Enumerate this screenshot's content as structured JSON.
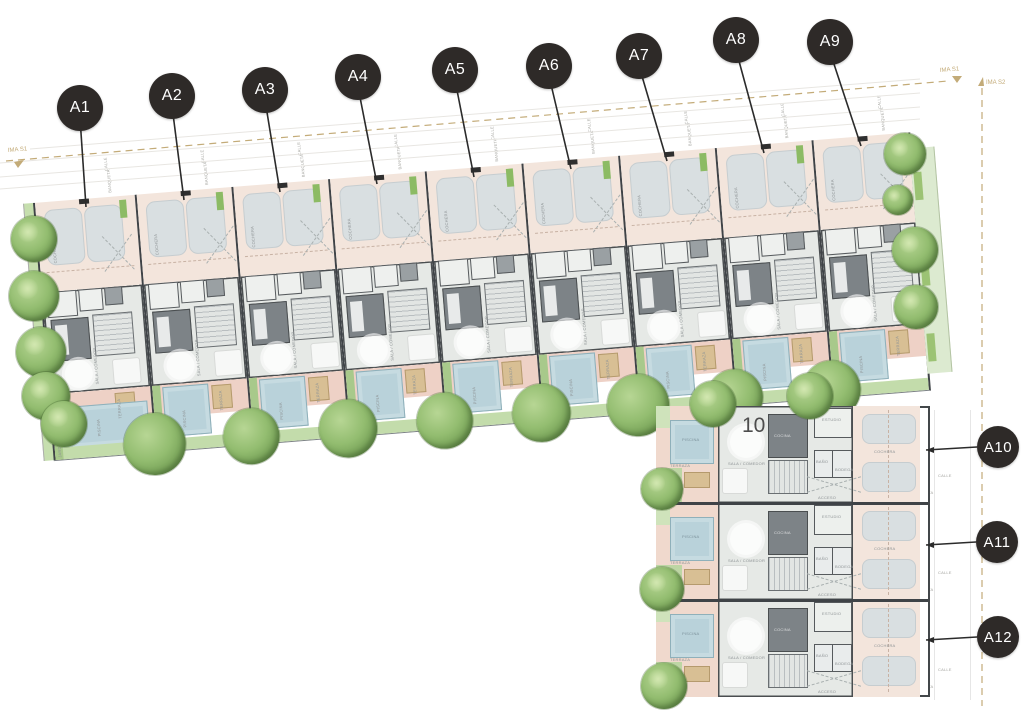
{
  "markers_row": [
    "A1",
    "A2",
    "A3",
    "A4",
    "A5",
    "A6",
    "A7",
    "A8",
    "A9"
  ],
  "markers_col": [
    "A10",
    "A11",
    "A12"
  ],
  "lot_number": "10",
  "rooms": {
    "cochera": "COCHERA",
    "sala_comedor": "SALA / COMEDOR",
    "cocina": "COCINA",
    "estudio": "ESTUDIO",
    "bano": "BAÑO",
    "bodega": "BODEGA",
    "acceso": "ACCESO",
    "terraza": "TERRAZA",
    "piscina": "PISCINA",
    "jardin": "JARDÍN"
  },
  "street": {
    "calle": "CALLE",
    "banqueta": "BANQUETA"
  },
  "boundary": {
    "line1": "IMA S1",
    "line2": "IMA S2"
  },
  "colors": {
    "marker": "#2e2a28",
    "cochera_floor": "#f3e5dc",
    "interior_floor": "#e6e9e6",
    "terrace_floor": "#eed1c6",
    "pool": "#b9d2da",
    "garden": "#c3dcab",
    "tree": "#6f9a51",
    "boundary_line": "#c3ab78",
    "wall": "#3f4347",
    "car_spot": "#d9dfe1"
  }
}
